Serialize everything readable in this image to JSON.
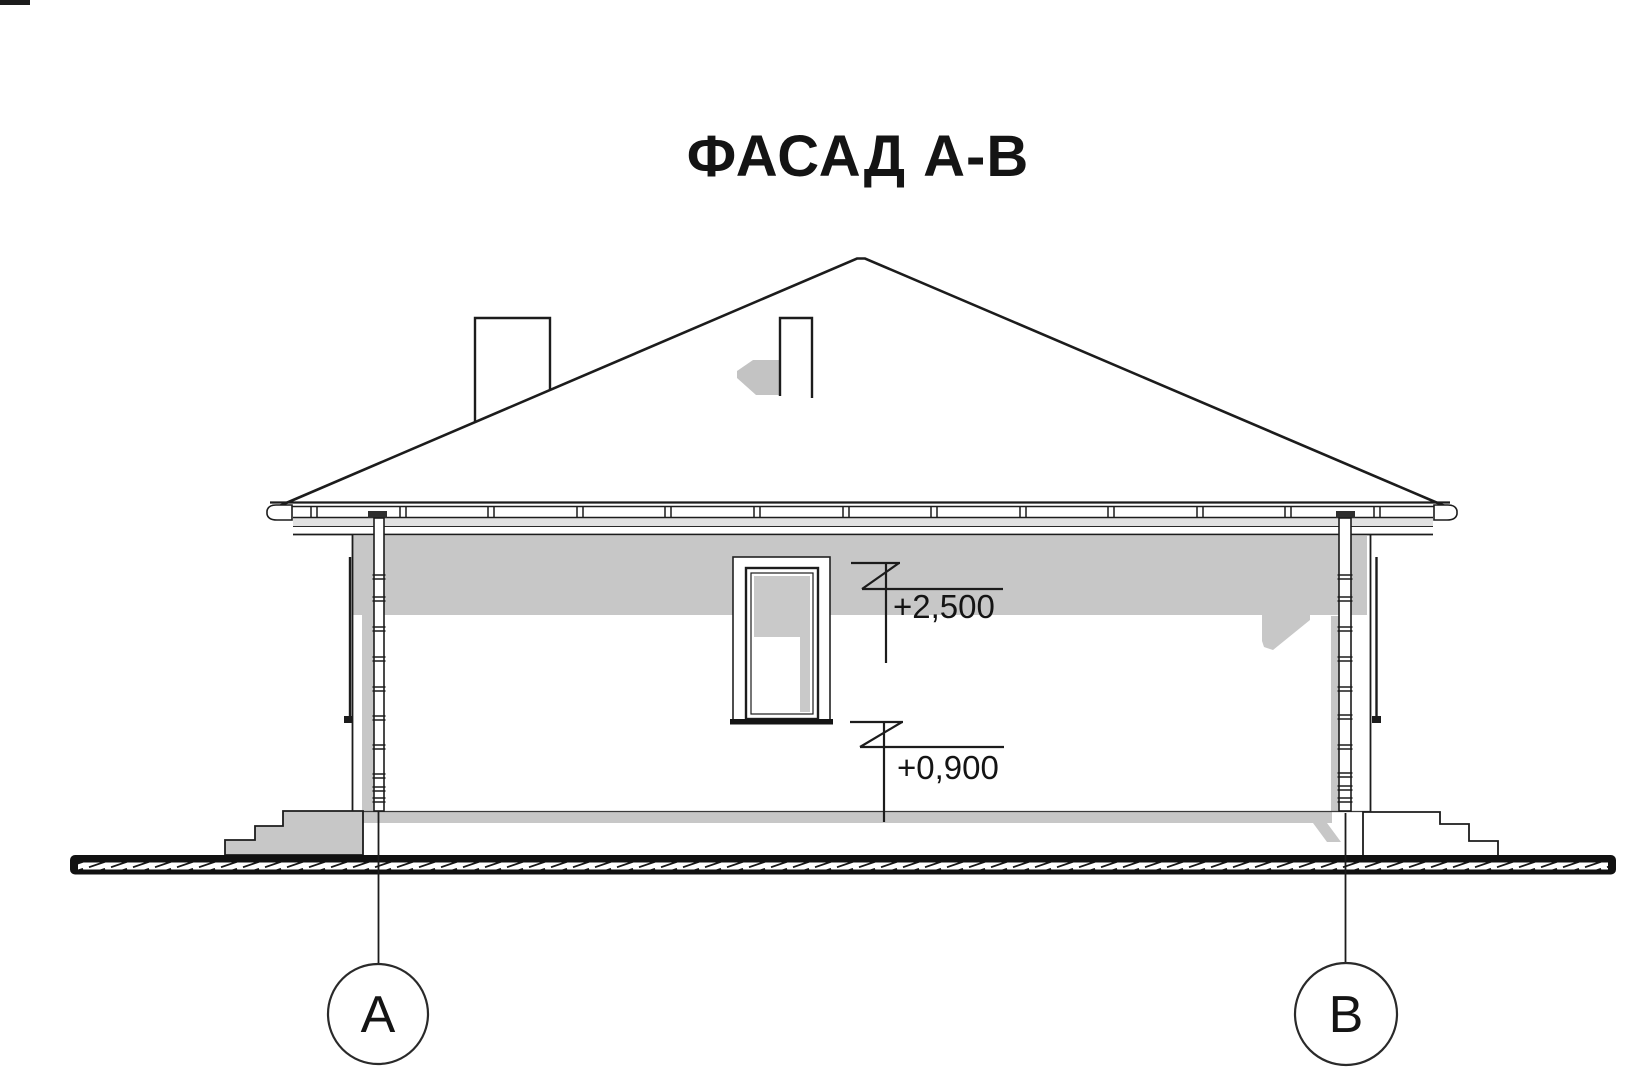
{
  "drawing": {
    "title": "ФАСАД А-В",
    "elevation_markers": [
      {
        "value": "+2,500"
      },
      {
        "value": "+0,900"
      }
    ],
    "axes": [
      {
        "label": "А"
      },
      {
        "label": "В"
      }
    ],
    "colors": {
      "line": "#1c1c1c",
      "shadow": "#c7c7c7",
      "eave_shade": "#e2e2e2",
      "ground": "#111111",
      "background": "#ffffff"
    }
  }
}
